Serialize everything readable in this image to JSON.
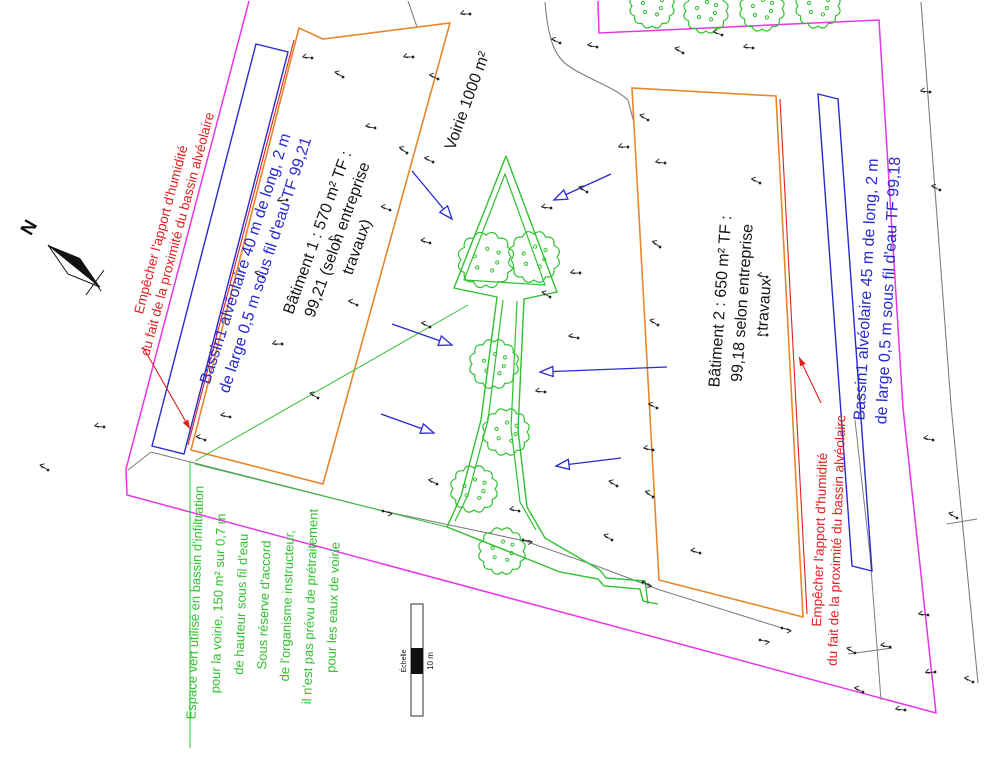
{
  "title": "Plan de masse - bassins alvéolaires et espaces verts",
  "colors": {
    "magenta": "#e935e9",
    "orange": "#e8862c",
    "blue": "#2a2acc",
    "red": "#dd2020",
    "green": "#2fc12f",
    "gray": "#7d7d7d",
    "black": "#151515"
  },
  "north": {
    "label": "N"
  },
  "scale": {
    "label": "Échelle",
    "value": "10 m"
  },
  "drawing": {
    "width": 995,
    "height": 768,
    "elements": [
      {
        "type": "poly",
        "name": "property-boundary-magenta",
        "points": "249,1 126,469 127,495 936,713 903,408 879,20 599,33 598,1",
        "stroke": "magenta",
        "sw": 1.5
      },
      {
        "type": "path",
        "name": "road-edge-curve",
        "d": "M545,2 C548,38 554,57 570,67 C588,79 614,87 628,100 L634,123",
        "stroke": "gray",
        "sw": 1.1
      },
      {
        "type": "poly",
        "name": "road-edge-tick",
        "points": "408,1 417,27",
        "stroke": "gray",
        "sw": 1.1
      },
      {
        "type": "poly",
        "name": "survey-line-right-outer",
        "points": "921,2 951,405 978,683",
        "stroke": "gray",
        "sw": 1.1
      },
      {
        "type": "poly",
        "name": "survey-line-right-connector",
        "points": "947,524 977,519",
        "stroke": "gray",
        "sw": 1.1
      },
      {
        "type": "poly",
        "name": "survey-line-right-lower",
        "points": "848,654 892,648",
        "stroke": "gray",
        "sw": 1.1
      },
      {
        "type": "poly",
        "name": "survey-line-basin2",
        "points": "855,420 870,555 881,700",
        "stroke": "gray",
        "sw": 1.0
      },
      {
        "type": "poly",
        "name": "survey-line-bottom",
        "points": "151,452 383,511 525,541 602,568 660,590 782,628",
        "stroke": "gray",
        "sw": 1.1
      },
      {
        "type": "poly",
        "name": "survey-line-corner",
        "points": "128,470 151,452",
        "stroke": "gray",
        "sw": 1.1
      },
      {
        "type": "polygon",
        "name": "batiment-1-outline",
        "points": "299,28 323,39 450,23 323,484 191,450",
        "stroke": "orange",
        "sw": 1.6
      },
      {
        "type": "polygon",
        "name": "batiment-2-outline",
        "points": "632,88 776,96 803,617 659,580",
        "stroke": "orange",
        "sw": 1.6
      },
      {
        "type": "polygon",
        "name": "bassin-1-outline",
        "points": "256,44 288,52 184,454 152,446",
        "stroke": "blue",
        "sw": 1.4
      },
      {
        "type": "polygon",
        "name": "bassin-2-outline",
        "points": "818,94 838,99 872,571 852,566",
        "stroke": "blue",
        "sw": 1.4
      },
      {
        "type": "poly",
        "name": "humidity-limit-line-1",
        "points": "294,40 188,445",
        "stroke": "red",
        "sw": 1.1
      },
      {
        "type": "poly",
        "name": "humidity-limit-line-2",
        "points": "780,99 807,614",
        "stroke": "red",
        "sw": 1.1
      },
      {
        "type": "path",
        "name": "espace-vert-outline-left",
        "d": "M506,156 L454,288 L497,297 L481,420 L461,496 L447,527 L560,572 L598,579 L604,586 L640,589 L643,601 L658,604",
        "stroke": "green",
        "sw": 1.4
      },
      {
        "type": "path",
        "name": "espace-vert-outline-right",
        "d": "M506,156 L557,292 L524,299 L518,430 L527,507 L545,538 L600,570 L606,578 L645,581 L648,604",
        "stroke": "green",
        "sw": 1.4
      },
      {
        "type": "path",
        "name": "espace-vert-inner-head",
        "d": "M505,174 L464,280 L545,285 Z",
        "stroke": "green",
        "sw": 1.2
      },
      {
        "type": "path",
        "name": "espace-vert-inner-left",
        "d": "M503,300 L488,420 L468,495 L455,521",
        "stroke": "green",
        "sw": 1.2
      },
      {
        "type": "path",
        "name": "espace-vert-inner-right",
        "d": "M517,301 L511,428 L520,502 L536,530",
        "stroke": "green",
        "sw": 1.2
      },
      {
        "type": "poly",
        "name": "espace-vert-text-underline",
        "points": "190,462 190,748",
        "stroke": "green",
        "sw": 1.0
      },
      {
        "type": "poly",
        "name": "espace-vert-leader-upper",
        "points": "195,461 468,305",
        "stroke": "green",
        "sw": 1.0
      },
      {
        "type": "poly",
        "name": "espace-vert-leader-lower",
        "points": "195,464 447,527",
        "stroke": "green",
        "sw": 1.0
      },
      {
        "type": "tree",
        "name": "tree",
        "cx": 486,
        "cy": 260,
        "r": 25
      },
      {
        "type": "tree",
        "name": "tree",
        "cx": 534,
        "cy": 257,
        "r": 23
      },
      {
        "type": "tree",
        "name": "tree",
        "cx": 494,
        "cy": 364,
        "r": 22
      },
      {
        "type": "tree",
        "name": "tree",
        "cx": 506,
        "cy": 432,
        "r": 21
      },
      {
        "type": "tree",
        "name": "tree",
        "cx": 474,
        "cy": 489,
        "r": 21
      },
      {
        "type": "tree",
        "name": "tree",
        "cx": 502,
        "cy": 551,
        "r": 21
      },
      {
        "type": "tree",
        "name": "tree",
        "cx": 652,
        "cy": 6,
        "r": 20
      },
      {
        "type": "tree",
        "name": "tree",
        "cx": 706,
        "cy": 11,
        "r": 20
      },
      {
        "type": "tree",
        "name": "tree",
        "cx": 762,
        "cy": 9,
        "r": 20
      },
      {
        "type": "tree",
        "name": "tree",
        "cx": 818,
        "cy": 6,
        "r": 20
      },
      {
        "type": "arrow",
        "name": "flow-arrow",
        "x1": 412,
        "y1": 171,
        "x2": 452,
        "y2": 219
      },
      {
        "type": "arrow",
        "name": "flow-arrow",
        "x1": 611,
        "y1": 174,
        "x2": 554,
        "y2": 200
      },
      {
        "type": "arrow",
        "name": "flow-arrow",
        "x1": 392,
        "y1": 324,
        "x2": 452,
        "y2": 345
      },
      {
        "type": "arrow",
        "name": "flow-arrow",
        "x1": 667,
        "y1": 367,
        "x2": 540,
        "y2": 372
      },
      {
        "type": "arrow",
        "name": "flow-arrow",
        "x1": 381,
        "y1": 414,
        "x2": 434,
        "y2": 433
      },
      {
        "type": "arrow",
        "name": "flow-arrow",
        "x1": 621,
        "y1": 458,
        "x2": 556,
        "y2": 466
      },
      {
        "type": "leader",
        "name": "red-leader-left",
        "points": [
          [
            143,
            347
          ],
          [
            190,
            429
          ]
        ],
        "stroke": "red"
      },
      {
        "type": "leader",
        "name": "red-leader-right",
        "points": [
          [
            821,
            403
          ],
          [
            799,
            357
          ]
        ],
        "stroke": "red"
      },
      {
        "type": "marks",
        "name": "survey-marks",
        "items": [
          [
            312,
            58,
            -15
          ],
          [
            343,
            77,
            10
          ],
          [
            413,
            57,
            -20
          ],
          [
            438,
            79,
            5
          ],
          [
            375,
            128,
            -10
          ],
          [
            407,
            153,
            15
          ],
          [
            287,
            200,
            -25
          ],
          [
            390,
            210,
            0
          ],
          [
            263,
            277,
            10
          ],
          [
            338,
            240,
            -15
          ],
          [
            357,
            305,
            5
          ],
          [
            282,
            344,
            -20
          ],
          [
            318,
            398,
            10
          ],
          [
            230,
            417,
            -10
          ],
          [
            205,
            440,
            0
          ],
          [
            104,
            427,
            -15
          ],
          [
            48,
            470,
            10
          ],
          [
            470,
            14,
            -20
          ],
          [
            560,
            43,
            5
          ],
          [
            597,
            47,
            -10
          ],
          [
            683,
            53,
            10
          ],
          [
            753,
            48,
            -15
          ],
          [
            722,
            35,
            0
          ],
          [
            648,
            120,
            10
          ],
          [
            628,
            147,
            -20
          ],
          [
            433,
            162,
            5
          ],
          [
            551,
            208,
            -15
          ],
          [
            587,
            192,
            10
          ],
          [
            430,
            243,
            -5
          ],
          [
            660,
            247,
            15
          ],
          [
            580,
            273,
            -20
          ],
          [
            430,
            327,
            5
          ],
          [
            578,
            338,
            -10
          ],
          [
            550,
            297,
            10
          ],
          [
            545,
            392,
            -15
          ],
          [
            437,
            484,
            5
          ],
          [
            519,
            511,
            -10
          ],
          [
            612,
            540,
            10
          ],
          [
            665,
            163,
            -15
          ],
          [
            760,
            183,
            5
          ],
          [
            767,
            277,
            -10
          ],
          [
            658,
            325,
            10
          ],
          [
            767,
            335,
            -20
          ],
          [
            657,
            408,
            5
          ],
          [
            653,
            450,
            -10
          ],
          [
            653,
            497,
            15
          ],
          [
            700,
            553,
            -5
          ],
          [
            617,
            486,
            10
          ],
          [
            930,
            92,
            -15
          ],
          [
            940,
            190,
            5
          ],
          [
            933,
            440,
            -10
          ],
          [
            957,
            518,
            10
          ],
          [
            928,
            615,
            -15
          ],
          [
            973,
            682,
            5
          ],
          [
            935,
            672,
            -25
          ],
          [
            855,
            653,
            10
          ],
          [
            890,
            647,
            -10
          ],
          [
            863,
            692,
            5
          ],
          [
            905,
            710,
            -15
          ],
          [
            383,
            511,
            175
          ],
          [
            523,
            540,
            170
          ],
          [
            643,
            582,
            185
          ],
          [
            782,
            628,
            175
          ],
          [
            760,
            640,
            170
          ]
        ]
      },
      {
        "type": "textblock",
        "name": "label-empecher-humidite-gauche",
        "x": 170,
        "y": 232,
        "rot": -75,
        "size": 13.5,
        "lh": 17,
        "color": "red",
        "lines": [
          "Empêcher l'apport d'humidité",
          "du fait de la proximité du bassin alvéolaire"
        ]
      },
      {
        "type": "textblock",
        "name": "label-bassin-1",
        "x": 256,
        "y": 262,
        "rot": -72,
        "size": 16,
        "lh": 21,
        "color": "blue",
        "lines": [
          "Bassin1 alvéolaire 40 m de long, 2 m",
          "de large 0,5 m sous fil d'eau TF 99,21"
        ]
      },
      {
        "type": "textblock",
        "name": "label-batiment-1",
        "x": 338,
        "y": 240,
        "rot": -70,
        "size": 16,
        "lh": 21,
        "color": "black",
        "lines": [
          "Bâtiment 1 : 570 m² TF :",
          "99,21 (selon entreprise",
          "travaux)"
        ]
      },
      {
        "type": "textblock",
        "name": "label-voirie",
        "x": 468,
        "y": 101,
        "rot": -70,
        "size": 16,
        "lh": 20,
        "color": "black",
        "lines": [
          "Voirie 1000 m²"
        ]
      },
      {
        "type": "textblock",
        "name": "label-batiment-2",
        "x": 743,
        "y": 303,
        "rot": -86,
        "size": 16,
        "lh": 22,
        "color": "black",
        "lines": [
          "Bâtiment 2 : 650 m² TF :",
          "99,18 selon entreprise",
          "travaux"
        ]
      },
      {
        "type": "textblock",
        "name": "label-bassin-2",
        "x": 878,
        "y": 290,
        "rot": -87,
        "size": 16,
        "lh": 22,
        "color": "blue",
        "lines": [
          "Bassin1 alvéolaire 45 m de long, 2 m",
          "de large 0,5 m sous fil d'eau TF 99,18"
        ]
      },
      {
        "type": "textblock",
        "name": "label-empecher-humidite-droite",
        "x": 829,
        "y": 540,
        "rot": -88,
        "size": 13.5,
        "lh": 17,
        "color": "red",
        "lines": [
          "Empêcher l'apport d'humidité",
          "du fait de la proximité du bassin alvéolaire"
        ]
      },
      {
        "type": "textblock",
        "name": "label-espace-vert",
        "x": 265,
        "y": 605,
        "rot": -88,
        "size": 13,
        "lh": 23,
        "color": "green",
        "lines": [
          "Espace vert utilisé en bassin d'infiltration",
          "pour la voirie, 150 m² sur 0,7 m",
          "de hauteur sous fil d'eau",
          "Sous réserve d'accord",
          "de l'organisme instructeur,",
          "il n'est pas prévu de prétraitement",
          "pour les eaux de voirie"
        ]
      },
      {
        "type": "north",
        "name": "north-arrow",
        "x1": 48,
        "y1": 245,
        "x2": 100,
        "y2": 287,
        "lx": 30,
        "ly": 228,
        "lrot": -60,
        "lsize": 19
      },
      {
        "type": "scalebar",
        "name": "scale-bar",
        "x": 411,
        "y": 604,
        "w": 12,
        "h": 112,
        "by": 44,
        "bh": 26
      }
    ]
  }
}
